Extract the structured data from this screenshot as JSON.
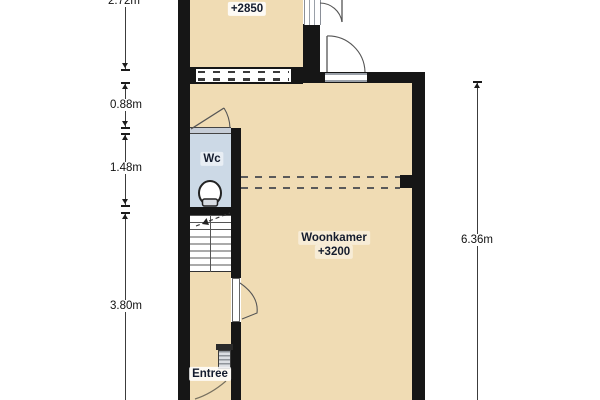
{
  "plan": {
    "rooms": {
      "top_room": {
        "label": "+2850"
      },
      "living": {
        "label": "Woonkamer",
        "sublabel": "+3200"
      },
      "wc": {
        "label": "Wc"
      },
      "entry": {
        "label": "Entree"
      }
    },
    "dimensions": {
      "left": [
        {
          "label": "2.72m"
        },
        {
          "label": "0.88m"
        },
        {
          "label": "1.48m"
        },
        {
          "label": "3.80m"
        }
      ],
      "right": [
        {
          "label": "6.36m"
        }
      ]
    },
    "colors": {
      "floor": "#f0dcb4",
      "wc_floor": "#ccd9e6",
      "wall": "#161616",
      "canvas": "#ffffff",
      "label_text": "#141c2e"
    }
  }
}
